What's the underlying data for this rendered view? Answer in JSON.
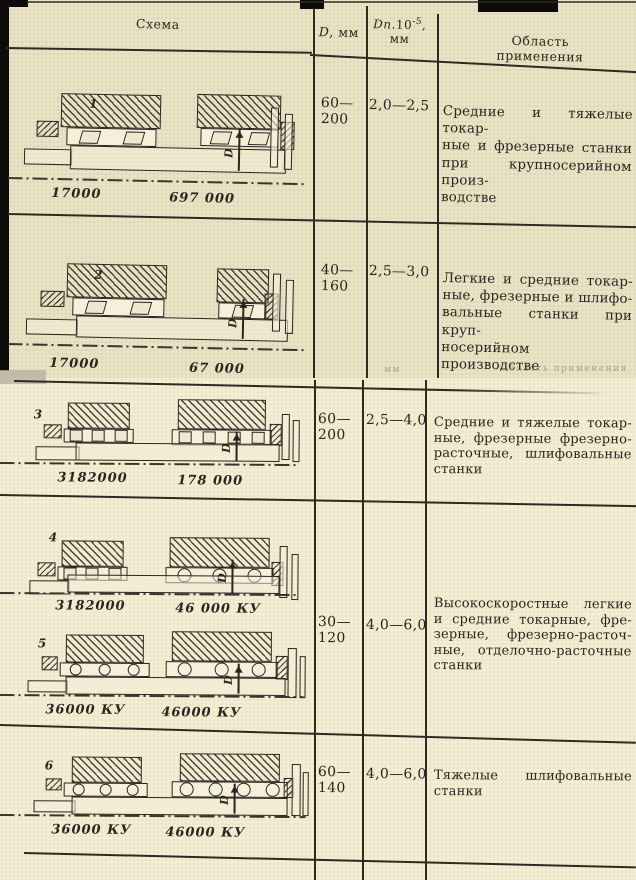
{
  "header": {
    "schema": "Схема",
    "d_italic": "D",
    "d_rest": ", мм",
    "dn_italic": "Dn",
    "dn_mult": ".10",
    "dn_sup": "-5",
    "dn_tail": ",",
    "dn_unit": "мм",
    "oblast": "Область применения"
  },
  "ghost": {
    "mm": "мм",
    "oblast": "Область применения"
  },
  "dim": "D",
  "schemes": [
    {
      "num": "1",
      "labels": [
        "17000",
        "697 000"
      ]
    },
    {
      "num": "2",
      "labels": [
        "17000",
        "67 000"
      ]
    },
    {
      "num": "3",
      "labels": [
        "3182000",
        "178 000"
      ]
    },
    {
      "num": "4",
      "labels": [
        "3182000",
        "46 000 КУ"
      ]
    },
    {
      "num": "5",
      "labels": [
        "36000 КУ",
        "46000 КУ"
      ]
    },
    {
      "num": "6",
      "labels": [
        "36000 КУ",
        "46000 КУ"
      ]
    }
  ],
  "cells": [
    {
      "d1": "60—",
      "d2": "200",
      "dn": "2,0—2,5",
      "app": [
        "Средние и тяжелые токар-",
        "ные и фрезерные станки",
        "при крупносерийном произ-",
        "водстве"
      ]
    },
    {
      "d1": "40—",
      "d2": "160",
      "dn": "2,5—3,0",
      "app": [
        "Легкие и средние токар-",
        "ные, фрезерные и шлифо-",
        "вальные станки при круп-",
        "носерийном производстве"
      ]
    },
    {
      "d1": "60—",
      "d2": "200",
      "dn": "2,5—4,0",
      "app": [
        "Средние и тяжелые токар-",
        "ные, фрезерные фрезерно-",
        "расточные, шлифовальные",
        "станки"
      ]
    },
    {
      "d1": "30—",
      "d2": "120",
      "dn": "4,0—6,0",
      "app": [
        "Высокоскоростные легкие",
        "и средние токарные, фре-",
        "зерные, фрезерно-расточ-",
        "ные, отделочно-расточные",
        "станки"
      ]
    },
    {
      "d1": "60—",
      "d2": "140",
      "dn": "4,0—6,0",
      "app": [
        "Тяжелые шлифовальные",
        "станки"
      ]
    }
  ]
}
